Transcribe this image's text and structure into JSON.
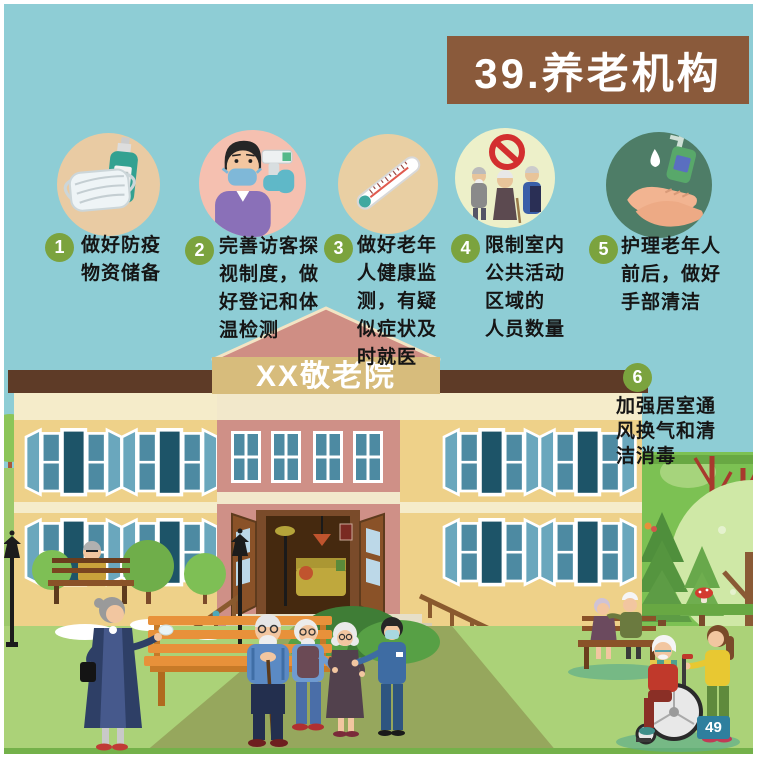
{
  "page": {
    "title": "39.养老机构",
    "building_sign": "XX敬老院",
    "page_number": "49"
  },
  "colors": {
    "background": "#8ecdd5",
    "banner_brown": "#8a5a3b",
    "number_badge_green": "#7ba33e",
    "page_badge_blue": "#2e7f9e",
    "text": "#151515"
  },
  "tips": [
    {
      "number": "1",
      "text": "做好防疫\n物资储备",
      "icon": "mask-and-sanitizer-icon",
      "icon_bg": "#e9cba3"
    },
    {
      "number": "2",
      "text": "完善访客探\n视制度，做\n好登记和体\n温检测",
      "icon": "visitor-temperature-check-icon",
      "icon_bg": "#f5c0b0"
    },
    {
      "number": "3",
      "text": "做好老年\n人健康监\n测，有疑\n似症状及\n时就医",
      "icon": "thermometer-icon",
      "icon_bg": "#e9cfa3"
    },
    {
      "number": "4",
      "text": "限制室内\n公共活动\n区域的\n人员数量",
      "icon": "limit-indoor-gathering-icon",
      "icon_bg": "#edf0c9"
    },
    {
      "number": "5",
      "text": "护理老年人\n前后，做好\n手部清洁",
      "icon": "hand-hygiene-icon",
      "icon_bg": "#4e7d67"
    },
    {
      "number": "6",
      "text": "加强居室通\n风换气和清\n洁消毒",
      "icon": null,
      "icon_bg": null
    }
  ]
}
